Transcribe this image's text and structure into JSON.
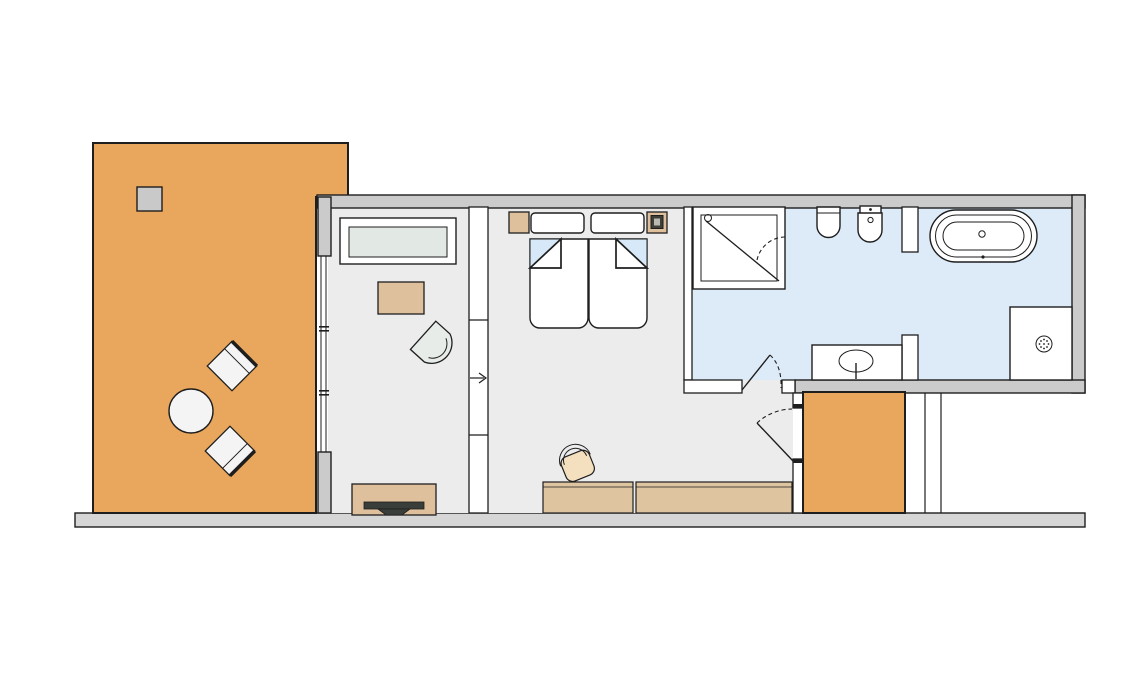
{
  "palette": {
    "background": "#ffffff",
    "line": "#1e1e1e",
    "deck": "#e9a75d",
    "floor": "#ececec",
    "bath_floor": "#ddeaf8",
    "wall": "#cbcbcb",
    "baseline": "#d6d6d6",
    "partition": "#ffffff",
    "furniture_tan": "#dfc09c",
    "bench_tan": "#dfc4a0",
    "chair_seat_tan": "#f4e0bf",
    "desk_top": "#e2e8e3",
    "chair_gray": "#e8ece8",
    "blanket_blue": "#d7e9f8",
    "planter_gray": "#c9c9c9",
    "tv_dark": "#3a3e3a",
    "fixture_white": "#ffffff",
    "table_white": "#f4f4f4"
  },
  "plan": {
    "type": "hotel-room-floor-plan",
    "rooms": [
      {
        "id": "terrace",
        "features": [
          "wood-deck",
          "planter",
          "round-table",
          "lounge-chair",
          "lounge-chair"
        ]
      },
      {
        "id": "living-room",
        "features": [
          "window-wall",
          "sideboard-desk",
          "tan-ottoman",
          "tub-chair",
          "tv-sideboard"
        ]
      },
      {
        "id": "bedroom",
        "features": [
          "twin-bed-left",
          "twin-bed-right",
          "nightstand-left",
          "nightstand-right-with-lamp",
          "console-desk",
          "desk-chair",
          "long-sideboard",
          "sliding-partition-with-arrow",
          "door-to-balcony"
        ]
      },
      {
        "id": "bathroom",
        "features": [
          "shower-cabin",
          "toilet",
          "bidet",
          "washbasin-counter",
          "freestanding-bathtub",
          "walk-in-shower-floor",
          "entry-door",
          "dividing-wall"
        ]
      },
      {
        "id": "balcony",
        "features": [
          "wood-deck",
          "privacy-screen"
        ]
      }
    ]
  }
}
